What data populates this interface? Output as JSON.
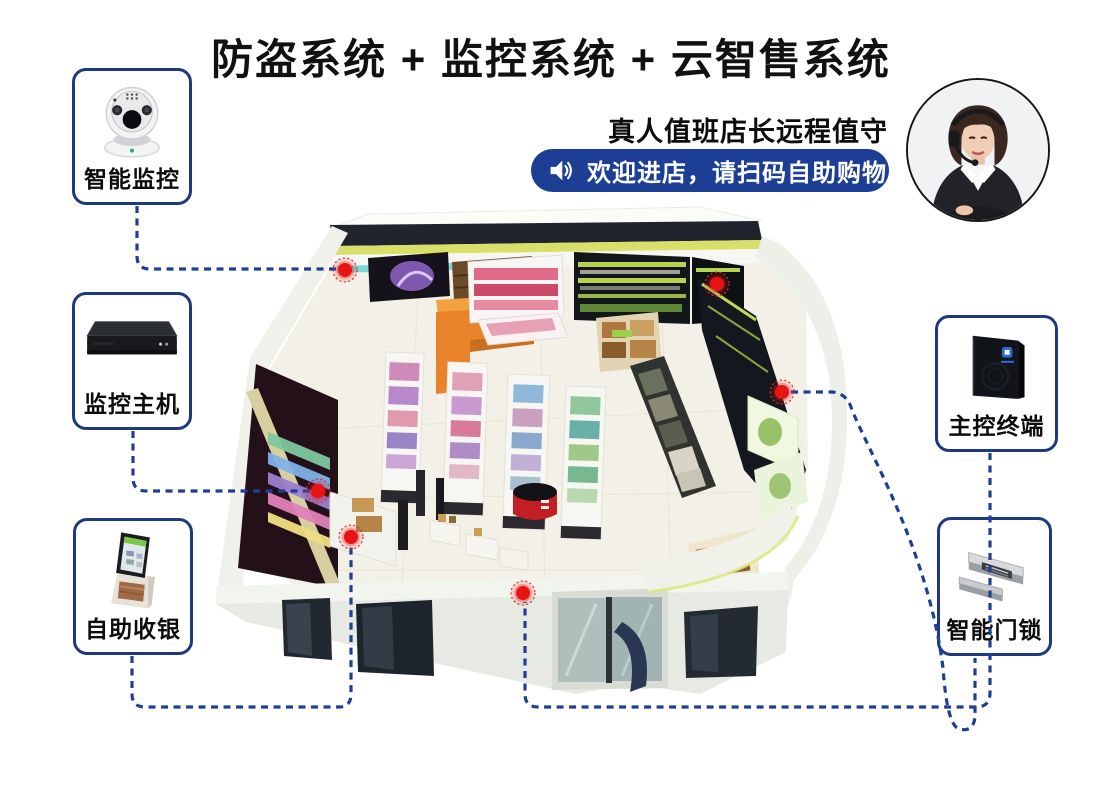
{
  "title": "防盗系统 + 监控系统 + 云智售系统",
  "header": {
    "caption": "真人值班店长远程值守",
    "announcement": "欢迎进店，请扫码自助购物",
    "announcement_icon": "speaker-icon"
  },
  "panels": {
    "smart_camera": {
      "label": "智能监控",
      "icon": "dome-camera-icon"
    },
    "monitor_host": {
      "label": "监控主机",
      "icon": "dvr-host-icon"
    },
    "self_checkout": {
      "label": "自助收银",
      "icon": "checkout-kiosk-icon"
    },
    "control_terminal": {
      "label": "主控终端",
      "icon": "control-terminal-icon"
    },
    "smart_lock": {
      "label": "智能门锁",
      "icon": "magnetic-lock-icon"
    }
  },
  "avatar": {
    "icon": "shopkeeper-portrait"
  },
  "colors": {
    "accent_blue": "#1e3f96",
    "pill_blue": "#1c3e94",
    "hotspot_red": "#e81414"
  },
  "store": {
    "hotspots": [
      "back-wall",
      "left-wall",
      "checkout-counter",
      "right-wall-top",
      "right-wall-mid",
      "front-door"
    ]
  }
}
